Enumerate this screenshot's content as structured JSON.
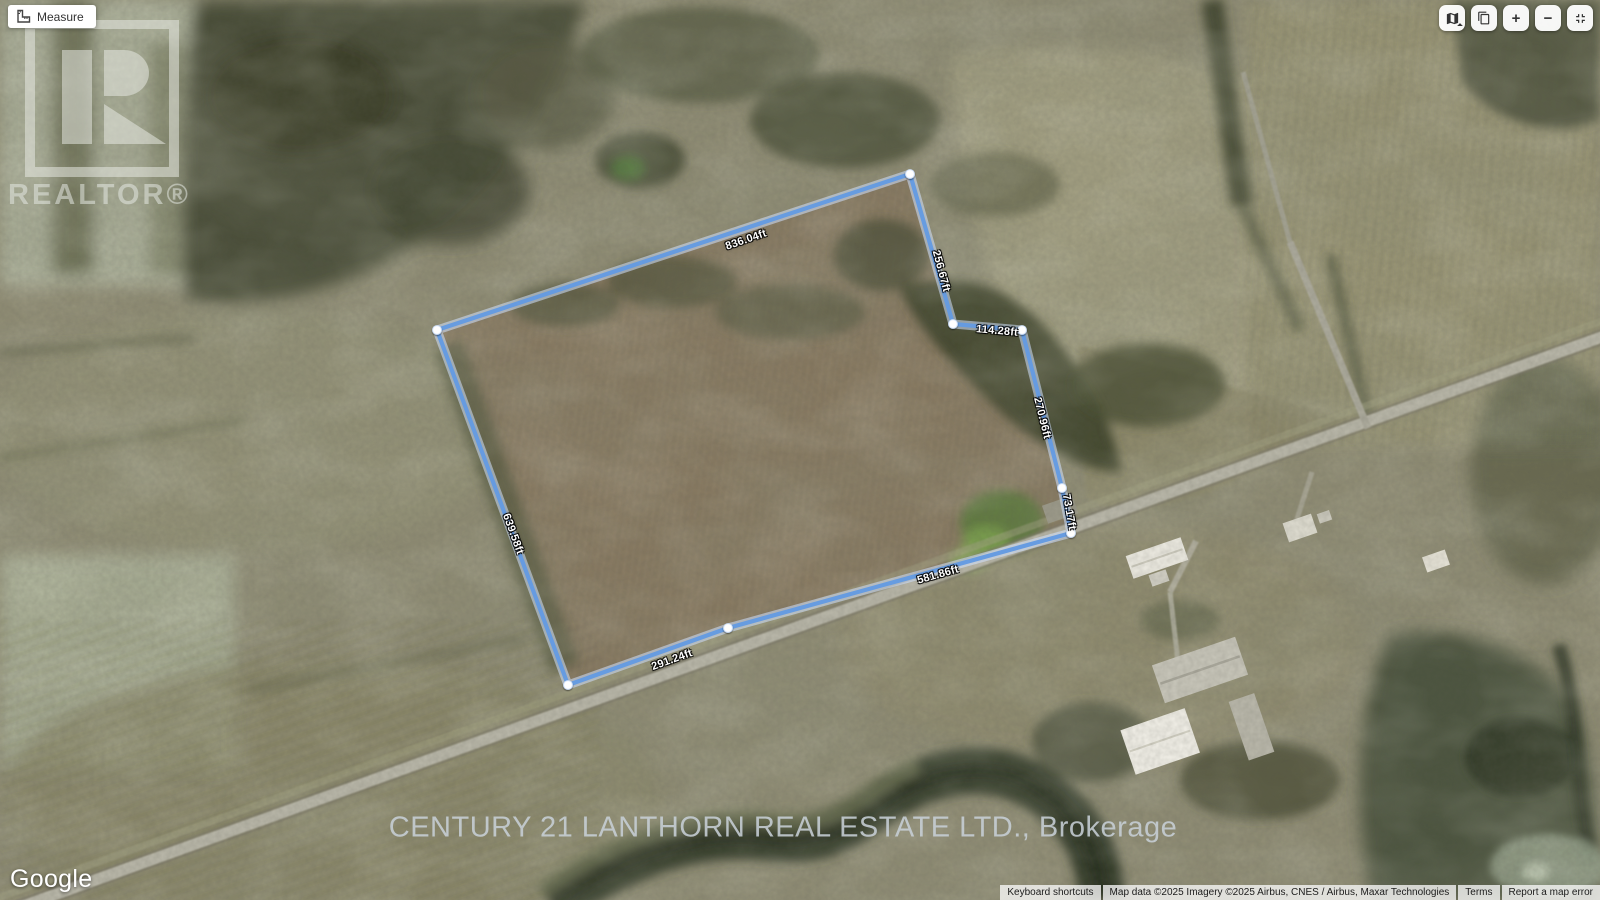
{
  "toolbar": {
    "measure_label": "Measure"
  },
  "map_controls": {
    "zoom_in_label": "+",
    "zoom_out_label": "−",
    "icons": [
      "map-type-icon",
      "tilt-tiles-icon",
      "zoom-in",
      "zoom-out",
      "fullscreen-exit-icon"
    ]
  },
  "measurements": {
    "top": "836.04ft",
    "right_upper": "256.67ft",
    "jog": "114.28ft",
    "right_lower": "270.96ft",
    "right_short": "73.17ft",
    "bottom_long": "581.86ft",
    "bottom_short": "291.24ft",
    "left": "639.58ft"
  },
  "watermarks": {
    "realtor_text": "REALTOR®",
    "brokerage": "CENTURY 21 LANTHORN REAL ESTATE LTD., Brokerage"
  },
  "attribution": {
    "google": "Google",
    "keyboard_shortcuts": "Keyboard shortcuts",
    "map_data": "Map data ©2025 Imagery ©2025 Airbus, CNES / Airbus, Maxar Technologies",
    "terms": "Terms",
    "report_error": "Report a map error"
  },
  "colors": {
    "measure_line": "#649be2",
    "measure_casing": "#d2e2ff",
    "vertex_fill": "#ffffff"
  }
}
